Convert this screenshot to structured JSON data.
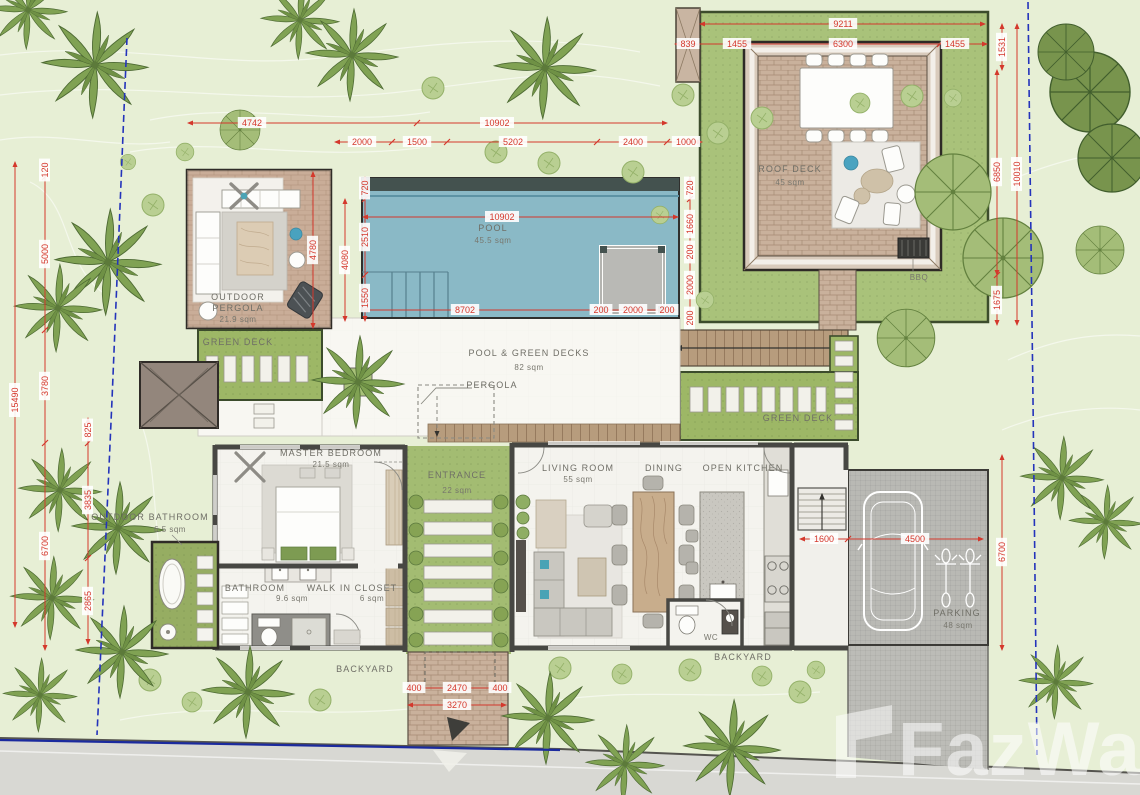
{
  "watermark": {
    "text": "FazWaz"
  },
  "rooms": [
    {
      "text": "ROOF DECK",
      "x": 790,
      "y": 172
    },
    {
      "text": "45 sqm",
      "x": 790,
      "y": 185,
      "sub": true
    },
    {
      "text": "POOL",
      "x": 493,
      "y": 231
    },
    {
      "text": "45.5 sqm",
      "x": 493,
      "y": 243,
      "sub": true
    },
    {
      "text": "OUTDOOR",
      "x": 238,
      "y": 300
    },
    {
      "text": "PERGOLA",
      "x": 238,
      "y": 311
    },
    {
      "text": "21.9 sqm",
      "x": 238,
      "y": 322,
      "sub": true
    },
    {
      "text": "GREEN DECK",
      "x": 238,
      "y": 345
    },
    {
      "text": "POOL & GREEN DECKS",
      "x": 529,
      "y": 356
    },
    {
      "text": "82 sqm",
      "x": 529,
      "y": 370,
      "sub": true
    },
    {
      "text": "PERGOLA",
      "x": 492,
      "y": 388
    },
    {
      "text": "GREEN DECK",
      "x": 798,
      "y": 421
    },
    {
      "text": "MASTER BEDROOM",
      "x": 331,
      "y": 456
    },
    {
      "text": "21.5 sqm",
      "x": 331,
      "y": 467,
      "sub": true
    },
    {
      "text": "ENTRANCE",
      "x": 457,
      "y": 478
    },
    {
      "text": "22 sqm",
      "x": 457,
      "y": 493,
      "sub": true
    },
    {
      "text": "LIVING ROOM",
      "x": 578,
      "y": 471
    },
    {
      "text": "55 sqm",
      "x": 578,
      "y": 482,
      "sub": true
    },
    {
      "text": "DINING",
      "x": 664,
      "y": 471
    },
    {
      "text": "OPEN KITCHEN",
      "x": 743,
      "y": 471
    },
    {
      "text": "OUTDOOR BATHROOM",
      "x": 150,
      "y": 520
    },
    {
      "text": "6.5 sqm",
      "x": 170,
      "y": 532,
      "sub": true
    },
    {
      "text": "BATHROOM",
      "x": 255,
      "y": 591
    },
    {
      "text": "9.6 sqm",
      "x": 292,
      "y": 601,
      "sub": true
    },
    {
      "text": "WALK IN CLOSET",
      "x": 352,
      "y": 591
    },
    {
      "text": "6 sqm",
      "x": 372,
      "y": 601,
      "sub": true
    },
    {
      "text": "WC",
      "x": 711,
      "y": 640,
      "sub": true
    },
    {
      "text": "BACKYARD",
      "x": 365,
      "y": 672
    },
    {
      "text": "BACKYARD",
      "x": 743,
      "y": 660
    },
    {
      "text": "PARKING",
      "x": 957,
      "y": 616
    },
    {
      "text": "48 sqm",
      "x": 958,
      "y": 628,
      "sub": true
    },
    {
      "text": "BBQ",
      "x": 919,
      "y": 280,
      "sub": true
    }
  ],
  "dims": [
    {
      "t": "4742",
      "x": 252,
      "y": 123,
      "r": 0
    },
    {
      "t": "10902",
      "x": 497,
      "y": 123,
      "r": 0
    },
    {
      "t": "2000",
      "x": 362,
      "y": 142,
      "r": 0
    },
    {
      "t": "1500",
      "x": 417,
      "y": 142,
      "r": 0
    },
    {
      "t": "5202",
      "x": 513,
      "y": 142,
      "r": 0
    },
    {
      "t": "2400",
      "x": 633,
      "y": 142,
      "r": 0
    },
    {
      "t": "1000",
      "x": 686,
      "y": 142,
      "r": 0
    },
    {
      "t": "9211",
      "x": 843,
      "y": 24,
      "r": 0
    },
    {
      "t": "839",
      "x": 688,
      "y": 44,
      "r": 0
    },
    {
      "t": "1455",
      "x": 737,
      "y": 44,
      "r": 0
    },
    {
      "t": "6300",
      "x": 843,
      "y": 44,
      "r": 0
    },
    {
      "t": "1455",
      "x": 955,
      "y": 44,
      "r": 0
    },
    {
      "t": "1531",
      "x": 1002,
      "y": 47,
      "r": -90
    },
    {
      "t": "6850",
      "x": 997,
      "y": 172,
      "r": -90
    },
    {
      "t": "1675",
      "x": 997,
      "y": 300,
      "r": -90
    },
    {
      "t": "10010",
      "x": 1017,
      "y": 174,
      "r": -90
    },
    {
      "t": "10902",
      "x": 502,
      "y": 217,
      "r": 0
    },
    {
      "t": "8702",
      "x": 465,
      "y": 310,
      "r": 0
    },
    {
      "t": "200",
      "x": 601,
      "y": 310,
      "r": 0
    },
    {
      "t": "2000",
      "x": 633,
      "y": 310,
      "r": 0
    },
    {
      "t": "200",
      "x": 667,
      "y": 310,
      "r": 0
    },
    {
      "t": "720",
      "x": 365,
      "y": 188,
      "r": -90
    },
    {
      "t": "2510",
      "x": 365,
      "y": 237,
      "r": -90
    },
    {
      "t": "1550",
      "x": 365,
      "y": 298,
      "r": -90
    },
    {
      "t": "4080",
      "x": 345,
      "y": 260,
      "r": -90
    },
    {
      "t": "4780",
      "x": 313,
      "y": 250,
      "r": -90
    },
    {
      "t": "720",
      "x": 690,
      "y": 188,
      "r": -90
    },
    {
      "t": "1660",
      "x": 690,
      "y": 224,
      "r": -90
    },
    {
      "t": "200",
      "x": 690,
      "y": 252,
      "r": -90
    },
    {
      "t": "2000",
      "x": 690,
      "y": 285,
      "r": -90
    },
    {
      "t": "200",
      "x": 690,
      "y": 318,
      "r": -90
    },
    {
      "t": "1600",
      "x": 824,
      "y": 539,
      "r": 0
    },
    {
      "t": "4500",
      "x": 915,
      "y": 539,
      "r": 0
    },
    {
      "t": "6700",
      "x": 1002,
      "y": 552,
      "r": -90
    },
    {
      "t": "120",
      "x": 45,
      "y": 170,
      "r": -90
    },
    {
      "t": "5000",
      "x": 45,
      "y": 254,
      "r": -90
    },
    {
      "t": "3780",
      "x": 45,
      "y": 386,
      "r": -90
    },
    {
      "t": "6700",
      "x": 45,
      "y": 546,
      "r": -90
    },
    {
      "t": "15490",
      "x": 15,
      "y": 400,
      "r": -90
    },
    {
      "t": "825",
      "x": 88,
      "y": 430,
      "r": -90
    },
    {
      "t": "3835",
      "x": 88,
      "y": 500,
      "r": -90
    },
    {
      "t": "2865",
      "x": 88,
      "y": 601,
      "r": -90
    },
    {
      "t": "400",
      "x": 414,
      "y": 688,
      "r": 0
    },
    {
      "t": "2470",
      "x": 457,
      "y": 688,
      "r": 0
    },
    {
      "t": "400",
      "x": 500,
      "y": 688,
      "r": 0
    },
    {
      "t": "3270",
      "x": 457,
      "y": 705,
      "r": 0
    }
  ]
}
